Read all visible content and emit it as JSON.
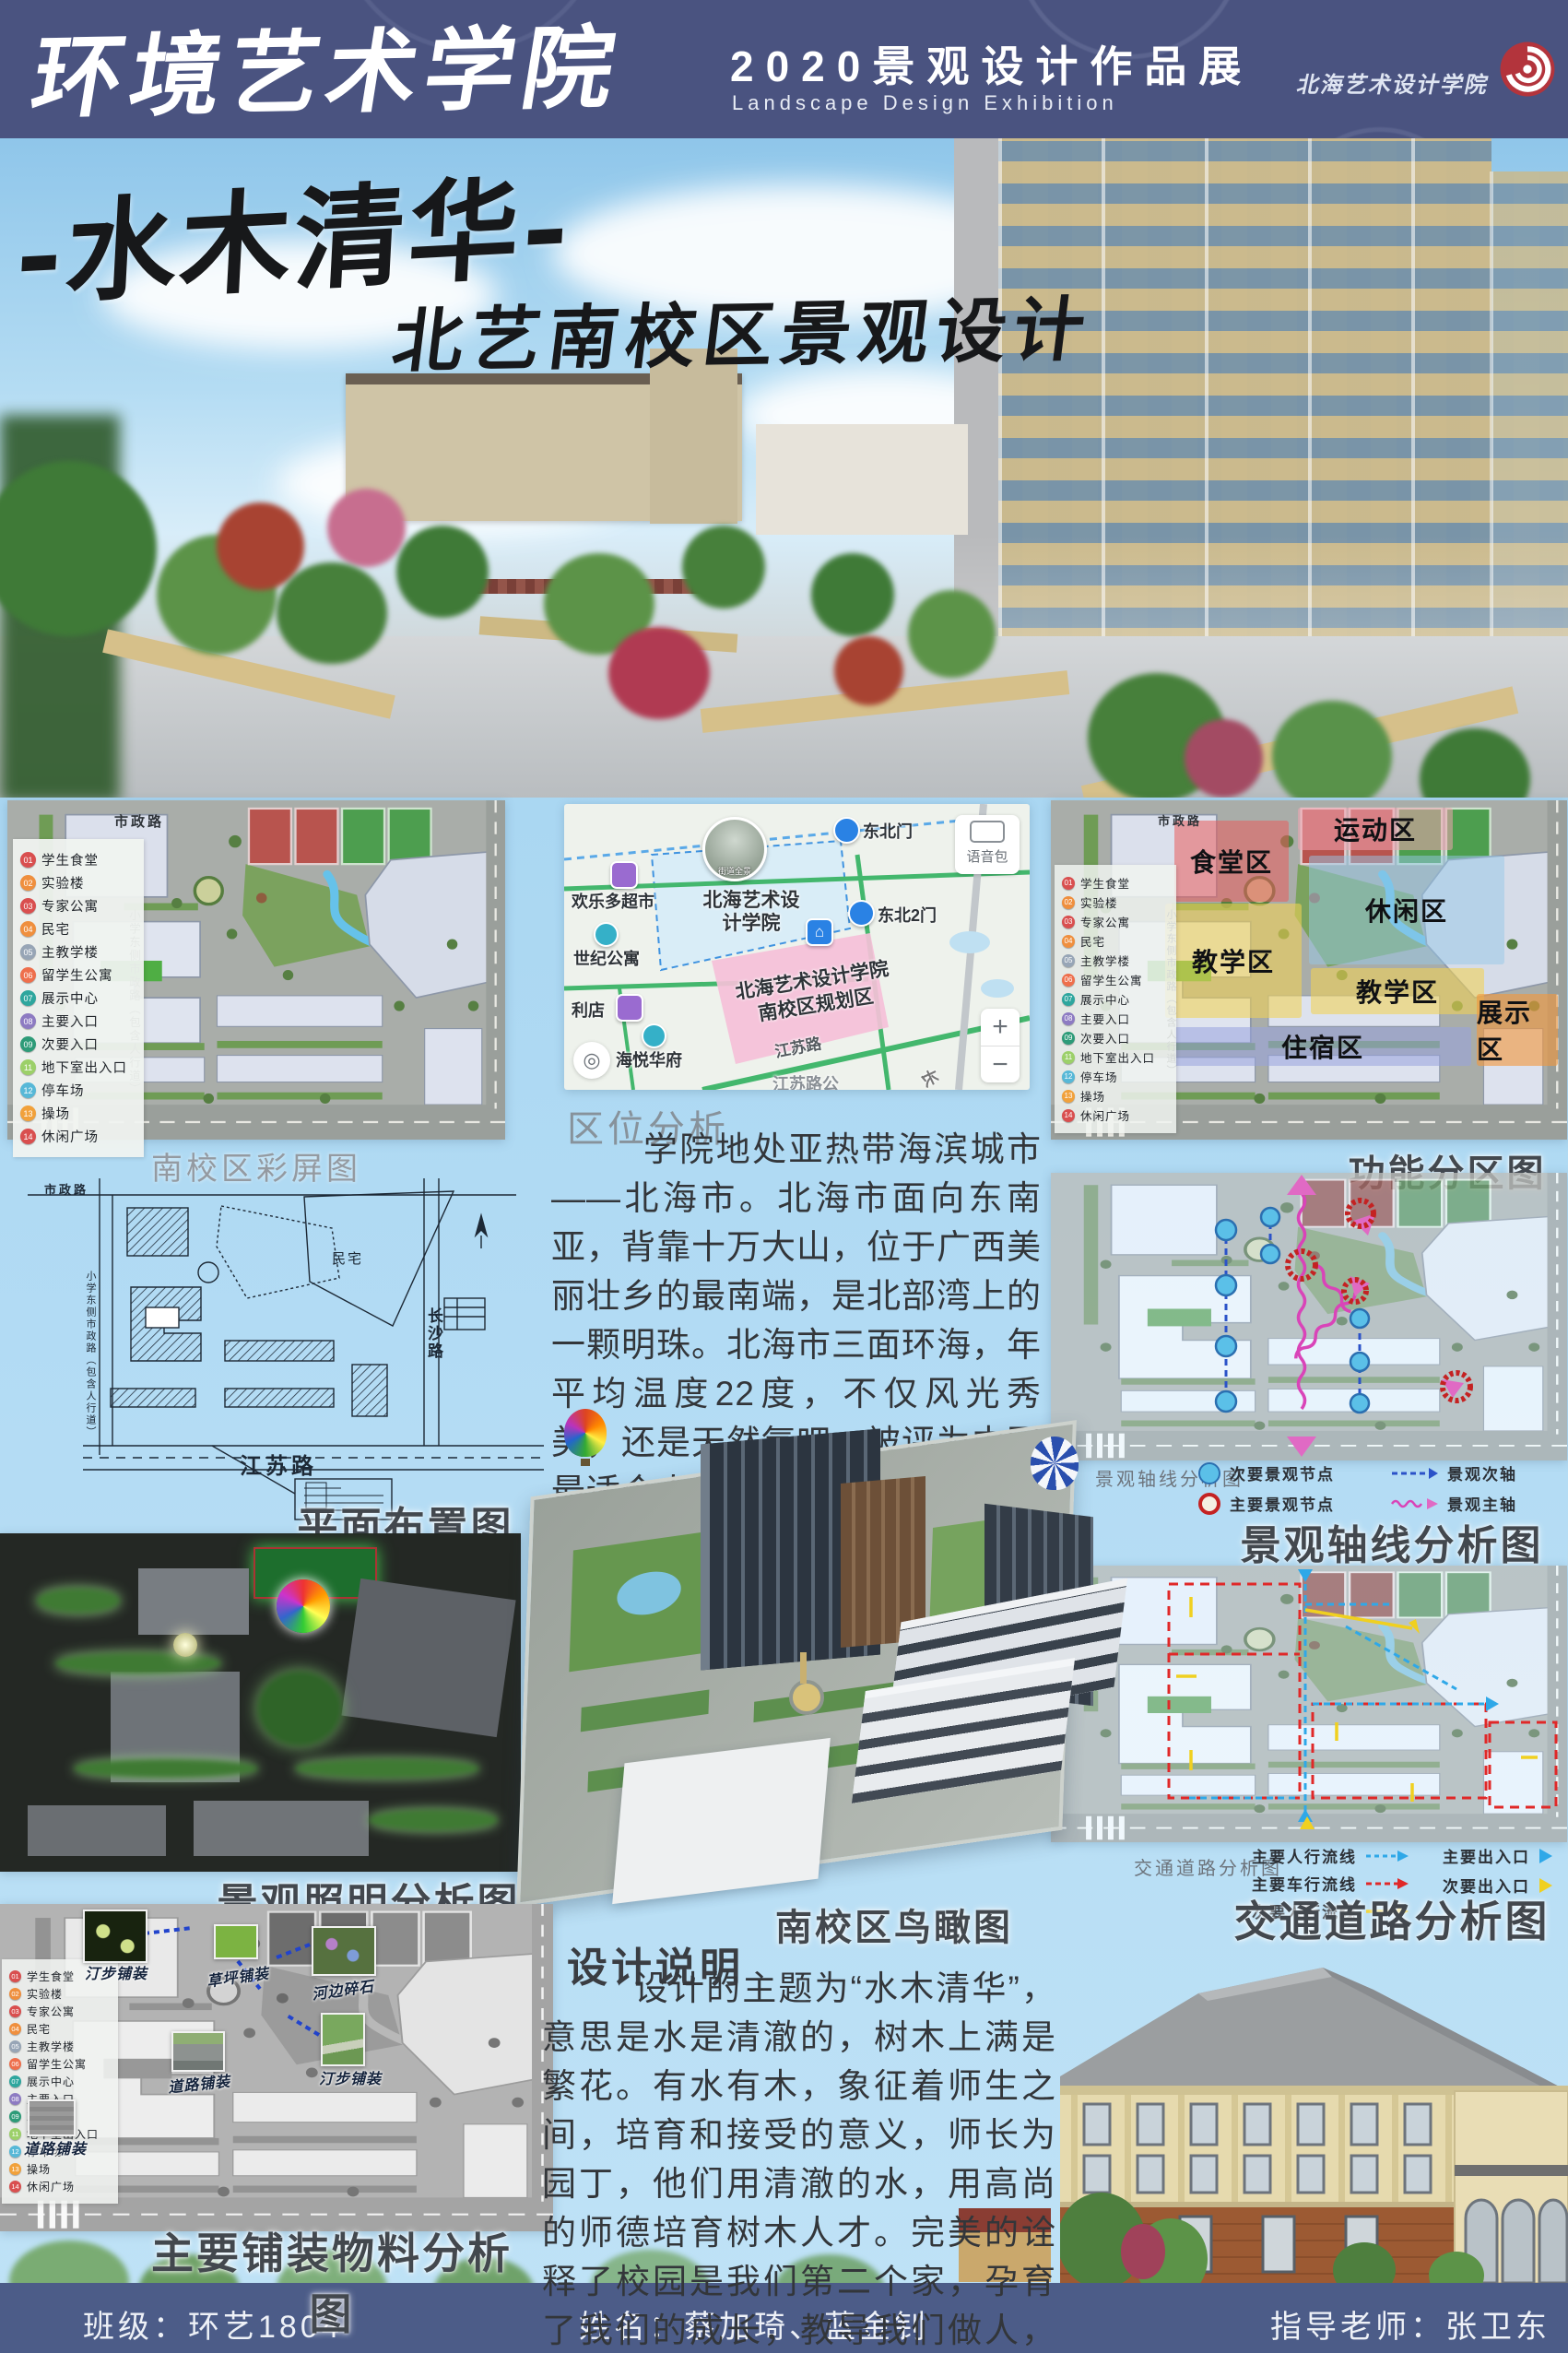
{
  "header": {
    "school_name": "环境艺术学院",
    "exhibition_title": "2020景观设计作品展",
    "exhibition_subtitle": "Landscape Design Exhibition",
    "logo_text": "北海艺术设计学院"
  },
  "hero": {
    "main_title": "-水木清华-",
    "subtitle": "北艺南校区景观设计"
  },
  "legend": {
    "items": [
      {
        "num": "01",
        "label": "学生食堂",
        "color": "#d94f4f"
      },
      {
        "num": "02",
        "label": "实验楼",
        "color": "#ef8f3e"
      },
      {
        "num": "03",
        "label": "专家公寓",
        "color": "#d94f4f"
      },
      {
        "num": "04",
        "label": "民宅",
        "color": "#ef8f3e"
      },
      {
        "num": "05",
        "label": "主教学楼",
        "color": "#97a5b6"
      },
      {
        "num": "06",
        "label": "留学生公寓",
        "color": "#ee6f4c"
      },
      {
        "num": "07",
        "label": "展示中心",
        "color": "#2ea69e"
      },
      {
        "num": "08",
        "label": "主要入口",
        "color": "#8d7bc2"
      },
      {
        "num": "09",
        "label": "次要入口",
        "color": "#2d9b78"
      },
      {
        "num": "11",
        "label": "地下室出入口",
        "color": "#9cd069"
      },
      {
        "num": "12",
        "label": "停车场",
        "color": "#57b8d7"
      },
      {
        "num": "13",
        "label": "操场",
        "color": "#f1a13b"
      },
      {
        "num": "14",
        "label": "休闲广场",
        "color": "#d94f4f"
      }
    ]
  },
  "roads": {
    "municipal": "市政路",
    "school_side": "小学东侧市政路（包含人行道）",
    "jiangsu": "江苏路",
    "changsha": "长沙路",
    "residence": "民宅"
  },
  "panels": {
    "color_plan": {
      "caption": "南校区彩屏图"
    },
    "zoning": {
      "caption": "功能分区图",
      "zones": [
        "食堂区",
        "运动区",
        "休闲区",
        "教学区",
        "教学区",
        "展示区",
        "住宿区"
      ]
    },
    "site_plan": {
      "caption": "平面布置图"
    },
    "axis": {
      "caption": "景观轴线分析图",
      "inner_label": "景观轴线分析图",
      "legend": [
        {
          "label": "次要景观节点"
        },
        {
          "label": "主要景观节点"
        },
        {
          "label": "景观次轴"
        },
        {
          "label": "景观主轴"
        }
      ]
    },
    "lighting": {
      "caption": "景观照明分析图"
    },
    "traffic": {
      "caption": "交通道路分析图",
      "inner_label": "交通道路分析图",
      "legend": [
        {
          "label": "主要人行流线"
        },
        {
          "label": "主要车行流线"
        },
        {
          "label": "次要人行流线"
        },
        {
          "label": "主要出入口"
        },
        {
          "label": "次要出入口"
        }
      ]
    },
    "paving": {
      "caption": "主要铺装物料分析图",
      "callouts": [
        "汀步铺装",
        "草坪铺装",
        "河边碎石",
        "汀步铺装",
        "道路铺装",
        "道路铺装"
      ]
    },
    "aerial": {
      "caption": "南校区鸟瞰图"
    }
  },
  "map": {
    "labels": {
      "gate_ne": "东北门",
      "gate_ne2": "东北2门",
      "supermarket": "欢乐多超市",
      "apartment": "世纪公寓",
      "store": "利店",
      "residence": "海悦华府",
      "college": "北海艺术设计学院",
      "street_view": "街道全景",
      "planning_zone": "北海艺术设计学院南校区规划区",
      "jiangsu_road": "江苏路",
      "jiangsu_stop": "江苏路公",
      "chang": "长"
    },
    "controls": {
      "voice_pack": "语音包",
      "zoom_in": "+",
      "zoom_out": "−"
    }
  },
  "location_analysis": {
    "title": "区位分析",
    "body": "学院地处亚热带海滨城市——北海市。北海市面向东南亚，背靠十万大山，位于广西美丽壮乡的最南端，是北部湾上的一颗明珠。北海市三面环海，年平均温度22度，不仅风光秀美，还是天然氧吧，被评为中国最适合人居的城市！"
  },
  "design_notes": {
    "title": "设计说明",
    "body": "设计的主题为“水木清华”，意思是水是清澈的，树木上满是繁花。有水有木，象征着师生之间，培育和接受的意义，师长为园丁，他们用清澈的水，用高尚的师德培育树木人才。完美的诠释了校园是我们第二个家，孕育了我们的成长，教导我们做人，是我们重要的港湾。"
  },
  "footer": {
    "class_label": "班级：环艺1804",
    "names_label": "姓名：蔡加琦、蓝金钊",
    "advisor_label": "指导老师：张卫东"
  },
  "colors": {
    "header_bg": "#4a5380",
    "footer_bg": "#4c5c88",
    "page_bg": "#aed9f3",
    "accent_red": "#b3343c"
  }
}
